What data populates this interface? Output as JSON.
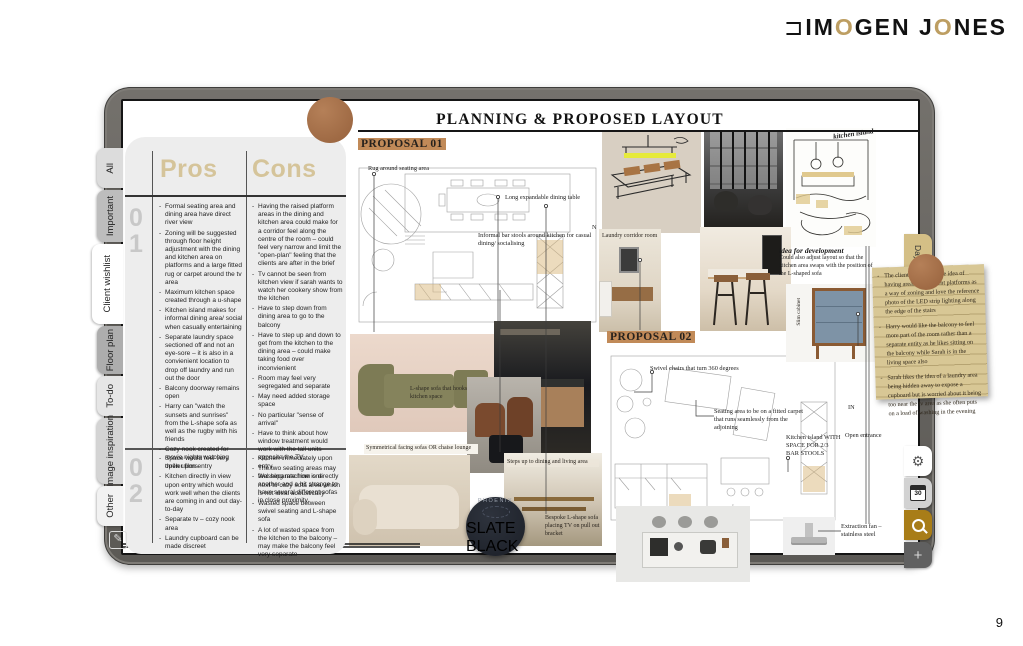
{
  "brand": {
    "mark": "⊐",
    "p1": "IM",
    "o1": "O",
    "p2": "GEN J",
    "o2": "O",
    "p3": "NES"
  },
  "title": "PLANNING & PROPOSED LAYOUT",
  "page_number": "9",
  "tabs": {
    "left": [
      {
        "label": "All"
      },
      {
        "label": "Important"
      },
      {
        "label": "Client wishlist"
      },
      {
        "label": "Floor plan"
      },
      {
        "label": "To-do"
      },
      {
        "label": "Image inspiration"
      },
      {
        "label": "Other"
      }
    ],
    "right_day": "Day"
  },
  "rail": {
    "gear_glyph": "⚙",
    "calendar_day": "30",
    "plus_glyph": "+"
  },
  "pros_cons": {
    "pros_header": "Pros",
    "cons_header": "Cons",
    "sections": [
      {
        "number": "01",
        "pros": [
          "Formal seating area and dining area have direct river view",
          "Zoning will be suggested through floor height adjustment with the dining and kitchen area on platforms and a large fitted rug or carpet around the tv area",
          "Maximum kitchen space created through a u-shape",
          "Kitchen island makes for informal dining area/ social when casually entertaining",
          "Separate laundry space sectioned off and not an eye-sore – it is also in a convienient location to drop off laundry and run out the door",
          "Balcony doorway remains open",
          "Harry can \"watch the sunsets and sunrises\" from the L-shape sofa as well as the rugby with his friends",
          "Cozy nook created for movie nights watching thriller films"
        ],
        "cons": [
          "Having the raised platform areas in the dining and kitchen area could make for a corridor feel along the centre of the room – could feel very narrow and limit the \"open-plan\" feeling that the clients are after in the brief",
          "Tv cannot be seen from kitchen view if sarah wants to watch her cookery show from the kitchen",
          "Have to step down from dining area to go to the balcony",
          "Have to step up and down to get from the kitchen to the dining area – could make taking food over inconvienient",
          "Room may feel very segregated and separate",
          "May need added storage space",
          "No particular \"sense of arrival\"",
          "Have to think about how window treatment would work with the tall units opposite the TV.",
          "The two seating areas may feel separate from one another and a bit strange to have several different sofas in close proximity"
        ]
      },
      {
        "number": "02",
        "pros": [
          "Space would feel very open upon entry",
          "Kitchen directly in view upon entry which would work well when the clients are coming in and out day-to-day",
          "Separate tv – cozy nook area",
          "Laundry cupboard can be made discreet"
        ],
        "cons": [
          "Kitchen immediately upon entry",
          "Washing machine is directly next to cozy sofa area which is not ideal acoustically",
          "Wasted space between swivel seating and L-shape sofa",
          "A lot of wasted space from the kitchen to the balcony – may make the balcony feel very separate"
        ]
      }
    ]
  },
  "proposals": [
    {
      "label": "PROPOSAL 01",
      "compass": "N",
      "annotations": [
        "Rug around seating area",
        "Long expandable dining table",
        "Informal bar stools around kitchen for casual dining/ socialising"
      ]
    },
    {
      "label": "PROPOSAL 02",
      "in_marker": "IN",
      "annotations": [
        "Swivel chairs that turn 360 degrees",
        "Seating area to be on a fitted carpet that runs seamlessly from the adjoining",
        "Kitchen island WITH SPACE FOR 2/3 BAR STOOLS",
        "Open entrance",
        "Extraction fan – stainless steel"
      ]
    }
  ],
  "image_labels": {
    "laundry": "Laundry corridor room",
    "l_shape_sofa": "L-shape sofa that hooks onto kitchen space",
    "symmetrical": "Symmetrical facing sofas OR chaise lounge",
    "steps_up": "Steps up to dining and living area",
    "bespoke": "Bespoke L-shape sofa placing TV on pull out bracket",
    "slim_cabinet": "Slim cabinet",
    "kitchen_island_note": "kitchen island"
  },
  "idea_note": {
    "title": "idea for development",
    "body": "Could also adjust layout so that the kitchen area swaps with the position of the L-shaped sofa"
  },
  "paint_badge": {
    "line1": "PHOENIX",
    "line2": "SLATE BLACK"
  },
  "sticky_note": {
    "items": [
      "The clients really like the idea of having areas on different platforms as a way of zoning and love the reference photo of the LED strip lighting along the edge of the stairs",
      "Harry would like the balcony to feel more part of the room rather than a separate entity as he likes sitting on the balcony while Sarah is in the living space also",
      "Sarah likes the idea of a laundry area being hidden away to expose a cupboard but is worried about it being too near the tv area as she often puts on a load of washing in the evening"
    ]
  },
  "colors": {
    "logo_gold": "#bd9e62",
    "proposal_highlight": "#c18a58",
    "sticky_note": "#d8c795",
    "brown_dot": "#a9734d",
    "search_tab": "#a87d18",
    "header_khaki": "#d5c49a"
  }
}
